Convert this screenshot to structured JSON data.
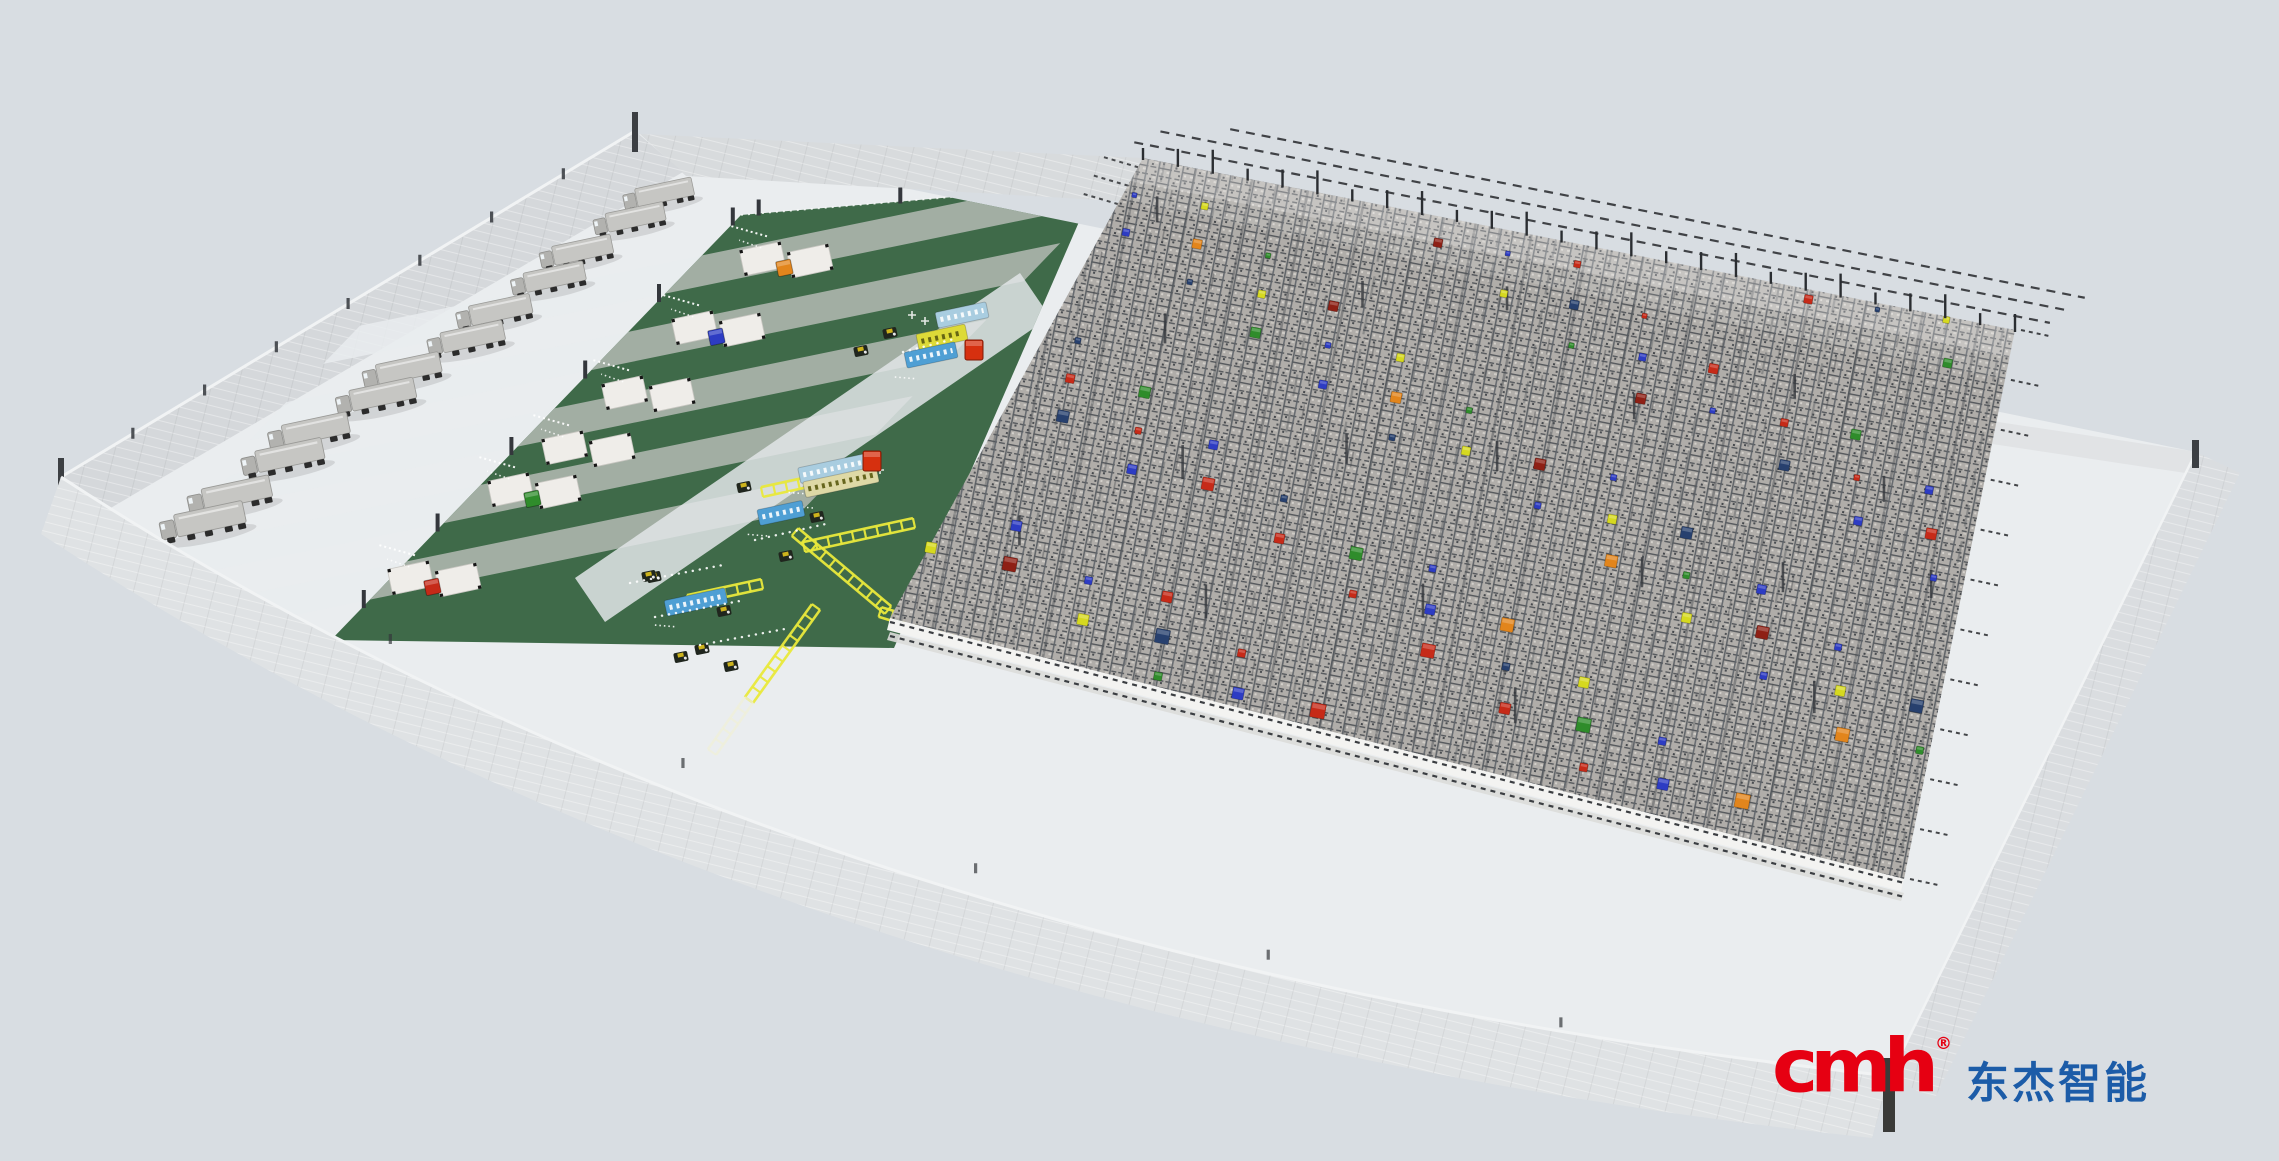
{
  "logo": {
    "brand": "cmh",
    "registered": "®",
    "brand_cn": "东杰智能",
    "brand_color": "#e60012",
    "cn_color": "#1c5ca8"
  },
  "colors": {
    "background": "#d8dde2",
    "floor": "#eaedef",
    "wall_face": "#d5d8db",
    "wall_face_light": "#dfe2e4",
    "wall_back": "#d8dbdd",
    "wall_right": "#dadde0",
    "wall_stub": "#e1e3e5",
    "wall_edge_highlight": "#f1f3f4",
    "green": "#3f6a49",
    "strip_light": "#a8b2a9",
    "ramp": "#e9ecee",
    "corridor": "#e2e5e8",
    "grid_yellow": "#e9e93c",
    "grid_pale": "#f0f0d8",
    "rack_base": "#b0ada9",
    "rack_line_dark": "#55585c",
    "rail_white": "#f3f3f1",
    "rail_gray": "#dcdcd9",
    "post_dark": "#34373c",
    "truck_body": "#c6c6c3",
    "truck_cab": "#b2b2af",
    "robot_body": "#20261e",
    "robot_cap": "#cdb31d",
    "conveyor": {
      "blue": "#4f9fd4",
      "lightblue": "#a9cde0",
      "yellow": "#ddda38",
      "paleyellow": "#ded9a6"
    },
    "station_pallet": "#efede9",
    "box_red": "#d6300f"
  },
  "geometry": {
    "floor_path": "M640,134 L2196,452 L1890,1076 Q800,960 61,477 Z",
    "front_wall_path": "M61,477 Q800,960 1890,1076 L1872,1138 Q780,1020 41,534 Z",
    "walls": {
      "back": [
        [
          640,
          134
        ],
        [
          1143,
          158
        ],
        [
          1135,
          202
        ],
        [
          686,
          176
        ]
      ],
      "left": [
        [
          635,
          131
        ],
        [
          683,
          172
        ],
        [
          109,
          509
        ],
        [
          61,
          477
        ]
      ],
      "right": [
        [
          2196,
          452
        ],
        [
          2240,
          473
        ],
        [
          1934,
          1100
        ],
        [
          1890,
          1076
        ]
      ],
      "stub": [
        [
          1985,
          420
        ],
        [
          2198,
          452
        ],
        [
          2192,
          474
        ],
        [
          1979,
          442
        ]
      ]
    },
    "green_quad": [
      [
        741,
        215
      ],
      [
        1095,
        185
      ],
      [
        894,
        648
      ],
      [
        331,
        640
      ]
    ],
    "strip_dir": [
      360,
      -74
    ],
    "light_strip_centers": [
      0.14,
      0.32,
      0.5,
      0.68,
      0.86
    ],
    "strip_halfwidth": 0.045,
    "ramp_lengths": [
      0.95,
      0.95,
      0.9,
      0.85,
      0.8
    ],
    "corridor": [
      [
        1050,
        317
      ],
      [
        1020,
        273
      ],
      [
        575,
        578
      ],
      [
        605,
        622
      ]
    ],
    "rack": [
      [
        1143,
        158
      ],
      [
        2015,
        330
      ],
      [
        1904,
        879
      ],
      [
        890,
        618
      ]
    ],
    "grid_roads": [
      [
        [
          762,
          492
        ],
        [
          872,
          468
        ],
        0
      ],
      [
        [
          804,
          547
        ],
        [
          914,
          523
        ],
        0
      ],
      [
        [
          795,
          532
        ],
        [
          888,
          610
        ],
        0
      ],
      [
        [
          816,
          607
        ],
        [
          749,
          700
        ],
        0
      ],
      [
        [
          688,
          600
        ],
        [
          762,
          584
        ],
        0
      ],
      [
        [
          880,
          612
        ],
        [
          990,
          645
        ],
        0
      ],
      [
        [
          749,
          700
        ],
        [
          712,
          752
        ],
        1
      ]
    ]
  },
  "trucks": [
    [
      663,
      198
    ],
    [
      634,
      223
    ],
    [
      581,
      256
    ],
    [
      553,
      283
    ],
    [
      499,
      316
    ],
    [
      471,
      343
    ],
    [
      407,
      375
    ],
    [
      381,
      401
    ],
    [
      314,
      436
    ],
    [
      288,
      462
    ],
    [
      235,
      500
    ],
    [
      208,
      526
    ]
  ],
  "stations": [
    [
      790,
      258,
      "#e2851c"
    ],
    [
      722,
      327,
      "#2d3cc3"
    ],
    [
      652,
      392,
      null
    ],
    [
      592,
      447,
      null
    ],
    [
      538,
      489,
      "#2f8c2b"
    ],
    [
      438,
      577,
      "#c62a18"
    ]
  ],
  "conveyors": [
    [
      962,
      315,
      "lightblue",
      52
    ],
    [
      942,
      337,
      "yellow",
      50
    ],
    [
      931,
      355,
      "blue",
      52
    ],
    [
      836,
      468,
      "lightblue",
      75
    ],
    [
      841,
      482,
      "paleyellow",
      75
    ],
    [
      781,
      513,
      "blue",
      46
    ],
    [
      696,
      602,
      "blue",
      62
    ]
  ],
  "robots": [
    [
      890,
      333
    ],
    [
      861,
      351
    ],
    [
      744,
      487
    ],
    [
      817,
      517
    ],
    [
      786,
      556
    ],
    [
      654,
      577
    ],
    [
      724,
      611
    ],
    [
      702,
      649
    ],
    [
      681,
      657
    ],
    [
      731,
      666
    ],
    [
      649,
      576
    ]
  ],
  "boxes": [
    [
      974,
      350
    ],
    [
      872,
      461
    ]
  ],
  "trails": [
    [
      [
        630,
        583
      ],
      [
        723,
        565
      ]
    ],
    [
      [
        655,
        617
      ],
      [
        745,
        600
      ]
    ],
    [
      [
        700,
        645
      ],
      [
        790,
        628
      ]
    ],
    [
      [
        755,
        540
      ],
      [
        830,
        523
      ]
    ],
    [
      [
        903,
        352
      ],
      [
        958,
        338
      ]
    ]
  ],
  "rack_items": {
    "palette": [
      "#2d3cc3",
      "#27406e",
      "#c62a18",
      "#2f8c2b",
      "#d6d91f",
      "#e2851c",
      "#8e2015"
    ],
    "cycle": [
      0,
      2,
      3,
      0,
      4,
      1,
      2,
      0,
      5,
      3,
      0,
      2,
      1,
      4,
      6
    ],
    "u": [
      0.618,
      0.236,
      0.854,
      0.472,
      0.09,
      0.708,
      0.326,
      0.944,
      0.562,
      0.18,
      0.798,
      0.416,
      0.034,
      0.652,
      0.27,
      0.888,
      0.506,
      0.124,
      0.742,
      0.36,
      0.978,
      0.596,
      0.214,
      0.832,
      0.45,
      0.068,
      0.686,
      0.304,
      0.922,
      0.54,
      0.158,
      0.776,
      0.394,
      0.012,
      0.63,
      0.248,
      0.866,
      0.484,
      0.102,
      0.72,
      0.338,
      0.956,
      0.574,
      0.192,
      0.81,
      0.428,
      0.046,
      0.664,
      0.282,
      0.9,
      0.518,
      0.136,
      0.754,
      0.372,
      0.99,
      0.608,
      0.226,
      0.844,
      0.462,
      0.08,
      0.698,
      0.316,
      0.934,
      0.552,
      0.17,
      0.788,
      0.406,
      0.024,
      0.642,
      0.26,
      0.878,
      0.496,
      0.114,
      0.732,
      0.35,
      0.968,
      0.586,
      0.204,
      0.822,
      0.44,
      0.058,
      0.676,
      0.294,
      0.912,
      0.53,
      0.148,
      0.766,
      0.384,
      0.002,
      0.62
    ],
    "v": [
      0.414,
      0.828,
      0.242,
      0.656,
      0.07,
      0.484,
      0.898,
      0.312,
      0.726,
      0.14,
      0.554,
      0.968,
      0.382,
      0.796,
      0.21,
      0.624,
      0.038,
      0.452,
      0.866,
      0.28,
      0.694,
      0.108,
      0.522,
      0.936,
      0.35,
      0.764,
      0.178,
      0.592,
      0.006,
      0.42,
      0.834,
      0.248,
      0.662,
      0.076,
      0.49,
      0.904,
      0.318,
      0.732,
      0.146,
      0.56,
      0.974,
      0.388,
      0.802,
      0.216,
      0.63,
      0.044,
      0.458,
      0.872,
      0.286,
      0.7,
      0.114,
      0.528,
      0.942,
      0.356,
      0.77,
      0.184,
      0.598,
      0.012,
      0.426,
      0.84,
      0.254,
      0.668,
      0.082,
      0.496,
      0.91,
      0.324,
      0.738,
      0.152,
      0.566,
      0.98,
      0.394,
      0.808,
      0.222,
      0.636,
      0.05,
      0.464,
      0.878,
      0.292,
      0.706,
      0.12,
      0.534,
      0.948,
      0.362,
      0.776,
      0.19,
      0.604,
      0.018,
      0.432,
      0.846,
      0.26
    ]
  },
  "rack_posts": [
    [
      0.05,
      0.12,
      26
    ],
    [
      0.12,
      0.35,
      30
    ],
    [
      0.2,
      0.6,
      34
    ],
    [
      0.08,
      0.8,
      30
    ],
    [
      0.3,
      0.2,
      26
    ],
    [
      0.35,
      0.5,
      30
    ],
    [
      0.28,
      0.85,
      34
    ],
    [
      0.45,
      0.15,
      24
    ],
    [
      0.5,
      0.45,
      30
    ],
    [
      0.48,
      0.75,
      34
    ],
    [
      0.62,
      0.3,
      26
    ],
    [
      0.68,
      0.6,
      30
    ],
    [
      0.6,
      0.9,
      36
    ],
    [
      0.78,
      0.2,
      24
    ],
    [
      0.82,
      0.55,
      30
    ],
    [
      0.9,
      0.35,
      26
    ],
    [
      0.88,
      0.75,
      32
    ],
    [
      0.97,
      0.5,
      28
    ]
  ]
}
